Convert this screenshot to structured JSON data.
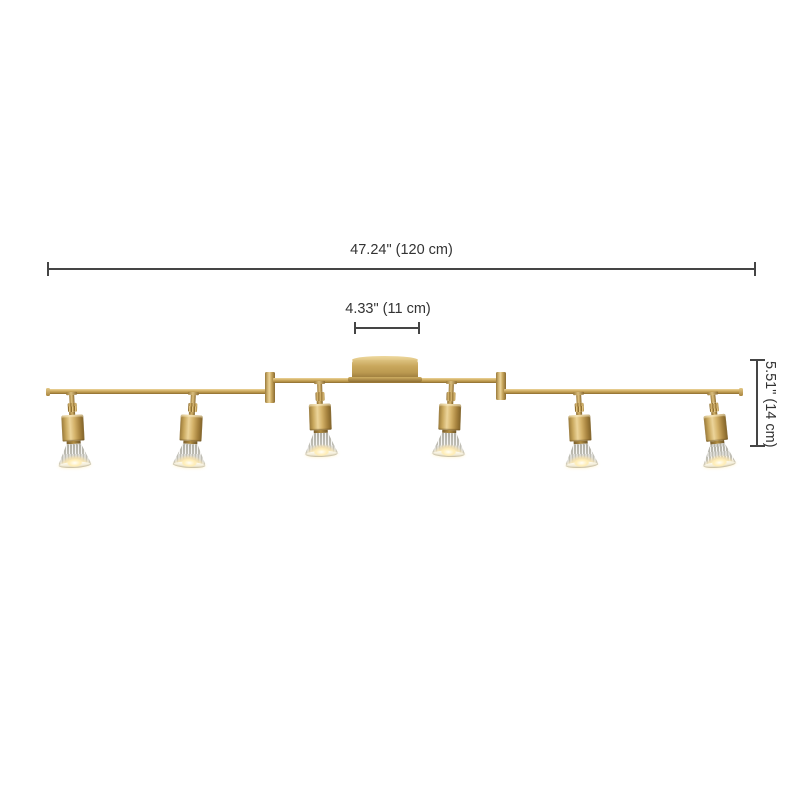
{
  "canvas": {
    "background": "#ffffff"
  },
  "dimensions": {
    "overall_width": {
      "label": "47.24\" (120 cm)"
    },
    "canopy_width": {
      "label": "4.33\" (11 cm)"
    },
    "fixture_height": {
      "label": "5.51\" (14 cm)"
    }
  },
  "fixture": {
    "type": "six-light adjustable track-bar ceiling light",
    "lamp_count": 6,
    "finish_color": "#c2a055",
    "glass_shade_color": "#dcdad2",
    "glow_color": "#ffedb5"
  },
  "style": {
    "dimension_line_color": "#454545",
    "dimension_text_color": "#333333"
  }
}
